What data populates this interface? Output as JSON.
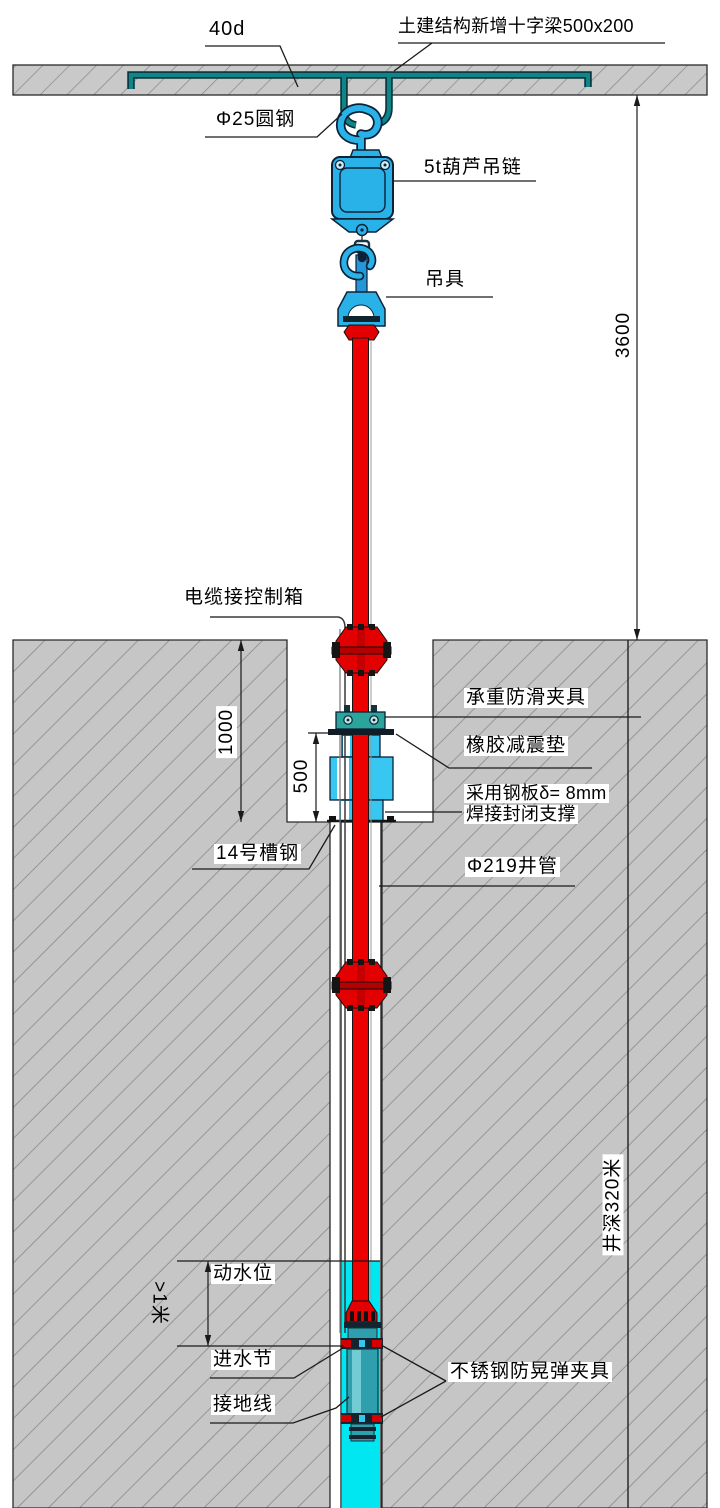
{
  "drawing": {
    "labels": {
      "anchor_length": "40d",
      "beam": "土建结构新增十字梁500x200",
      "round_steel": "Φ25圆钢",
      "hoist": "5t葫芦吊链",
      "lifting_device": "吊具",
      "cable_to_control_box": "电缆接控制箱",
      "load_clamp": "承重防滑夹具",
      "rubber_pad": "橡胶减震垫",
      "steel_plate_line1": "采用钢板δ= 8mm",
      "steel_plate_line2": "焊接封闭支撑",
      "channel_steel": "14号槽钢",
      "well_pipe": "Φ219井管",
      "dynamic_water_level": "动水位",
      "water_inlet": "进水节",
      "ground_wire": "接地线",
      "anti_sway_clamp": "不锈钢防晃弹夹具"
    },
    "dimensions": {
      "ceiling_to_ground": "3600",
      "pit_depth": "1000",
      "support_height": "500",
      "min_submergence": ">1米",
      "well_depth": "井深320米"
    },
    "colors": {
      "hatch_bg": "#c6c6c6",
      "hatch_line": "#8e8e8e",
      "hoist_blue": "#29b2e8",
      "support_cyan": "#38c7f1",
      "clamp_teal": "#2ba49b",
      "rod_teal": "#0f858a",
      "pipe_red": "#ec0000",
      "water_cyan": "#00e7f2",
      "pump_teal": "#2f9fae",
      "outline_navy": "#0d2137"
    }
  }
}
